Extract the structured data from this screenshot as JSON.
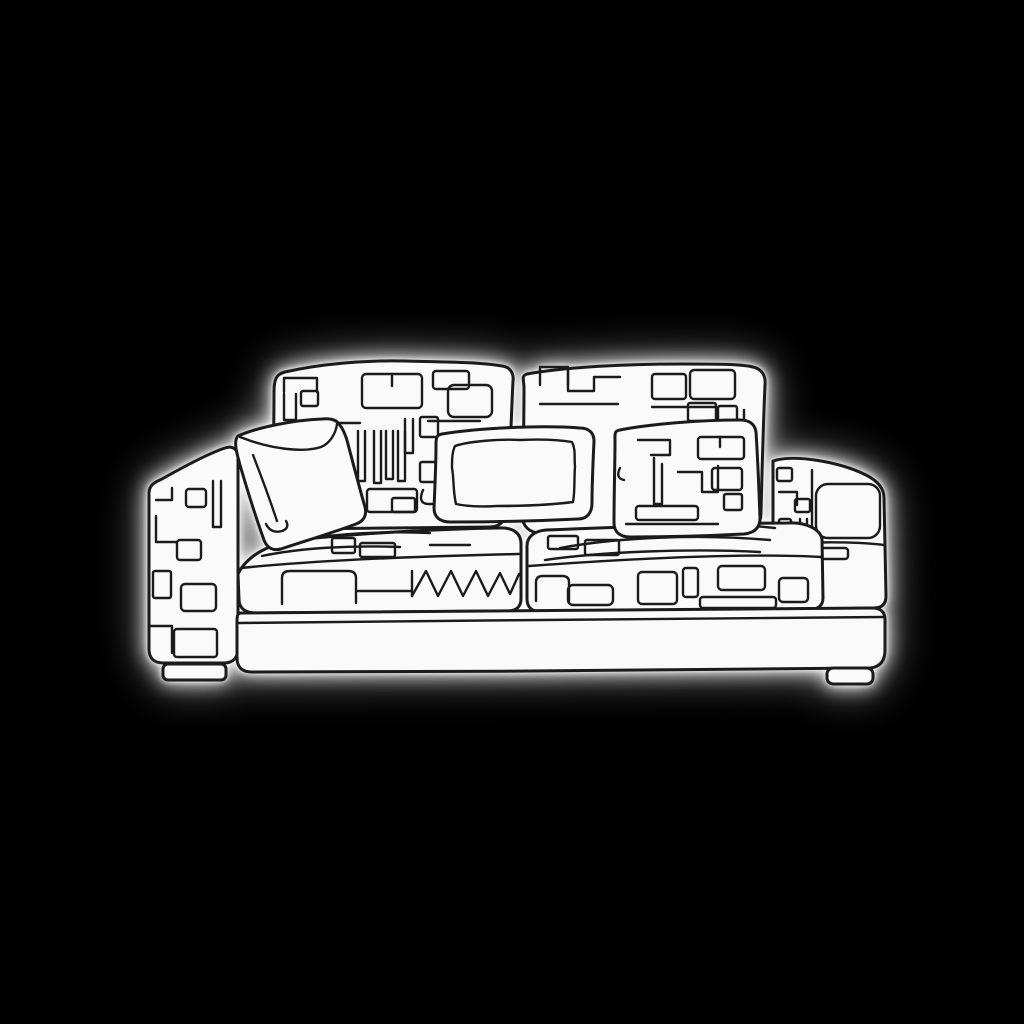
{
  "figure": {
    "subject": "Continuous one-line drawing of a modern sofa with maze-patterned back cushions, two plain throw pillows, one patterned throw pillow, patterned seat cushions, a tall patterned left armrest, a low right armrest, a plain base and two small feet",
    "style": "single-line art, white shapes with dark outline and soft white glow on a black background"
  },
  "colors": {
    "background": "#000000",
    "line": "#1b1b1b",
    "fill": "#fafafa",
    "glow": "#ffffff"
  }
}
